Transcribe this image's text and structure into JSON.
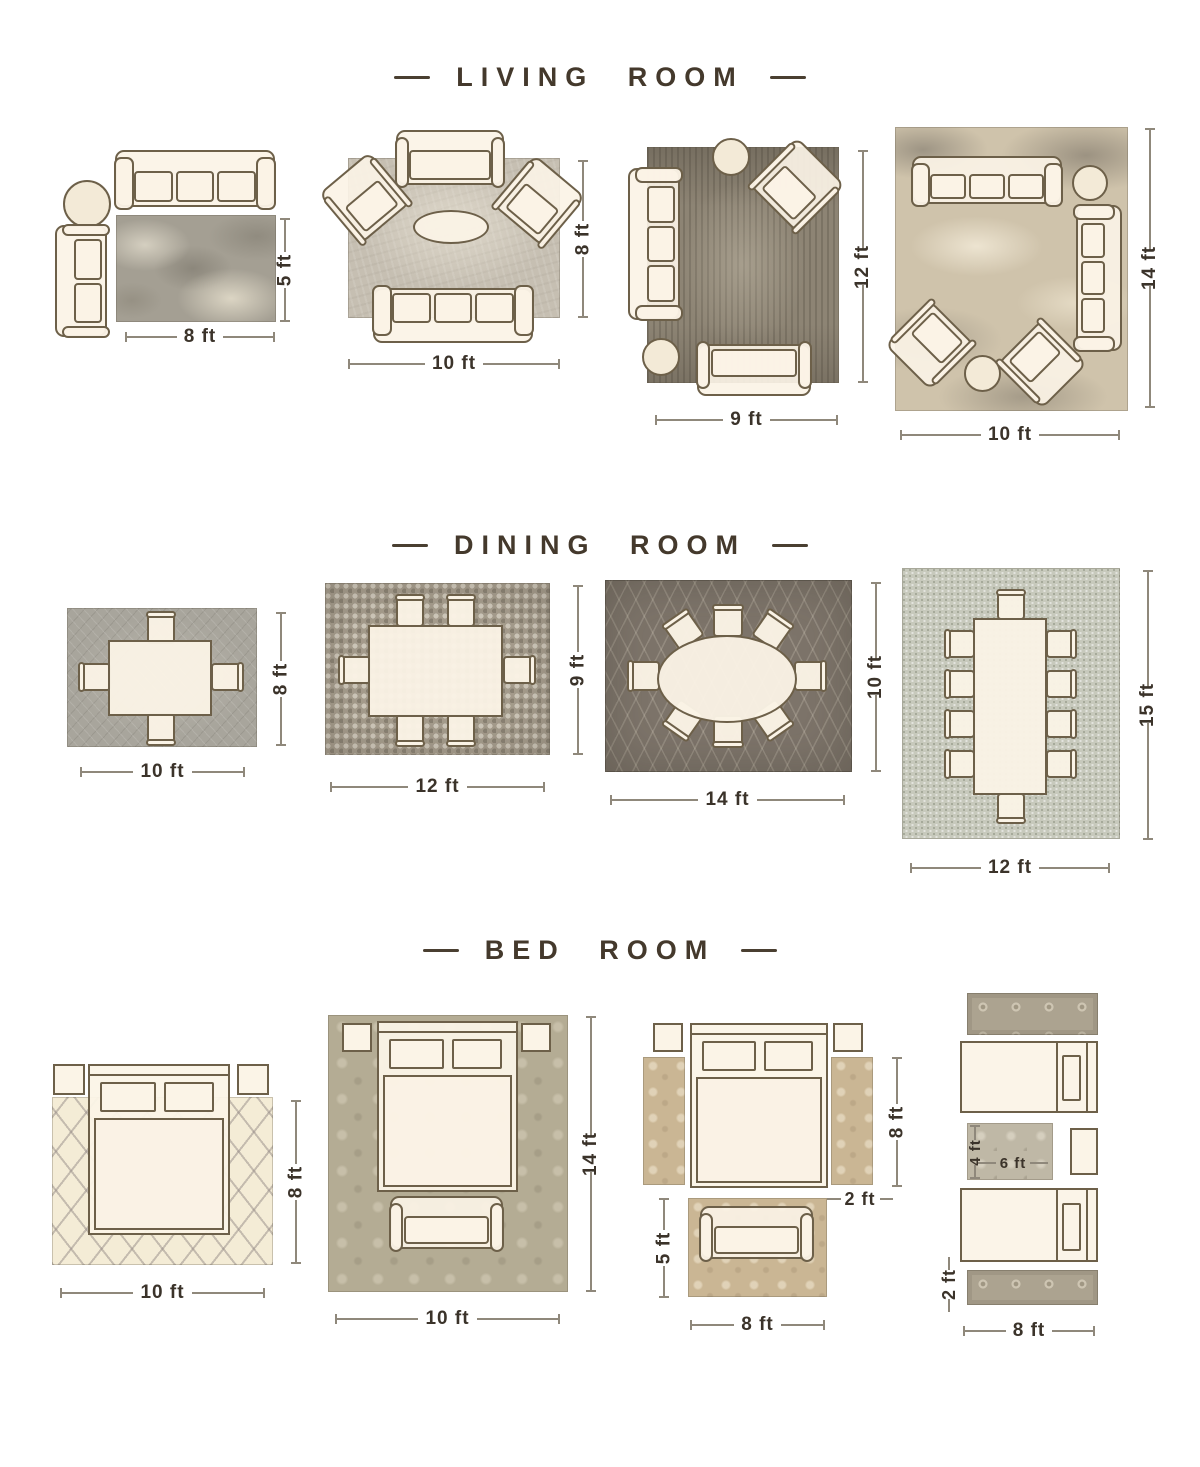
{
  "page": {
    "background": "#ffffff"
  },
  "colors": {
    "title_text": "#44392c",
    "dimension_text": "#3b332a",
    "dimension_line": "#8f887b",
    "furniture_outline": "#6d6049",
    "furniture_fill": "#faf2e5",
    "rug_living_1": "#a49f93",
    "rug_living_2": "#c6bfb2",
    "rug_living_3": "#8d8474",
    "rug_living_4": "#cfc3ab",
    "rug_dining_1": "#a8a59c",
    "rug_dining_2": "#a79e8e",
    "rug_dining_3": "#7d746a",
    "rug_dining_4": "#c7c9bc",
    "rug_bed_1": "#f4ecd6",
    "rug_bed_2": "#b4ac94",
    "rug_bed_3": "#cab694",
    "rug_bed_4": "#aca390"
  },
  "sections": [
    {
      "title": "LIVING ROOM",
      "diagrams": [
        {
          "name": "living-room-layout-1",
          "width": "8 ft",
          "height": "5 ft",
          "furniture": [
            "sofa",
            "side-table",
            "loveseat",
            "area-rug"
          ]
        },
        {
          "name": "living-room-layout-2",
          "width": "10 ft",
          "height": "8 ft",
          "furniture": [
            "loveseat",
            "armchair",
            "armchair",
            "coffee-table",
            "sofa",
            "area-rug"
          ]
        },
        {
          "name": "living-room-layout-3",
          "width": "9 ft",
          "height": "12 ft",
          "furniture": [
            "side-table",
            "armchair",
            "sofa",
            "ottoman",
            "loveseat",
            "area-rug"
          ]
        },
        {
          "name": "living-room-layout-4",
          "width": "10 ft",
          "height": "14 ft",
          "furniture": [
            "sofa",
            "side-table",
            "sofa",
            "armchair",
            "armchair",
            "ottoman",
            "area-rug"
          ]
        }
      ]
    },
    {
      "title": "DINING ROOM",
      "diagrams": [
        {
          "name": "dining-room-layout-1",
          "width": "10 ft",
          "height": "8 ft",
          "seats": 4
        },
        {
          "name": "dining-room-layout-2",
          "width": "12 ft",
          "height": "9 ft",
          "seats": 6
        },
        {
          "name": "dining-room-layout-3",
          "width": "14 ft",
          "height": "10 ft",
          "seats": 8
        },
        {
          "name": "dining-room-layout-4",
          "width": "12 ft",
          "height": "15 ft",
          "seats": 10
        }
      ]
    },
    {
      "title": "BED ROOM",
      "diagrams": [
        {
          "name": "bed-room-layout-1",
          "width": "10 ft",
          "height": "8 ft",
          "furniture": [
            "bed",
            "nightstand",
            "nightstand",
            "area-rug"
          ]
        },
        {
          "name": "bed-room-layout-2",
          "width": "10 ft",
          "height": "14 ft",
          "furniture": [
            "bed",
            "nightstand",
            "nightstand",
            "bench",
            "area-rug"
          ]
        },
        {
          "name": "bed-room-layout-3",
          "width": "8 ft",
          "height": "5 ft",
          "runner_length": "8 ft",
          "runner_width": "2 ft",
          "furniture": [
            "bed",
            "nightstand",
            "nightstand",
            "runner-rug",
            "runner-rug",
            "loveseat",
            "area-rug"
          ]
        },
        {
          "name": "bed-room-layout-4",
          "width": "8 ft",
          "runner_width": "2 ft",
          "accent_width": "6 ft",
          "accent_height": "4 ft",
          "furniture": [
            "twin-bed",
            "twin-bed",
            "nightstand",
            "runner-rug",
            "runner-rug",
            "accent-rug"
          ]
        }
      ]
    }
  ]
}
